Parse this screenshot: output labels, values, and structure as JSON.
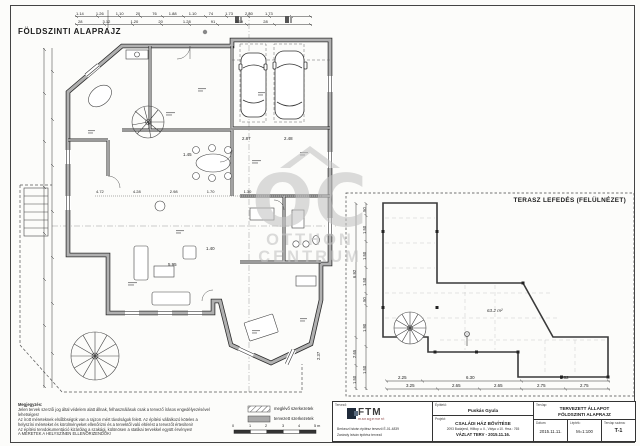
{
  "sheet": {
    "plan_title": "FÖLDSZINTI ALAPRAJZ",
    "terrace_title": "TERASZ LEFEDÉS (FELÜLNÉZET)"
  },
  "watermark": {
    "letters": "OC",
    "line1": "OTTHON",
    "line2": "CENTRUM"
  },
  "plan": {
    "dims_top_row1": [
      "1.14",
      "1.26",
      "1.10",
      "20",
      "76",
      "1.88",
      "1.10",
      "74",
      "1.73",
      "2.80",
      "1.73"
    ],
    "dims_top_row2": [
      "28",
      "3.12",
      "1.20",
      "20",
      "1.28",
      "91",
      "3.19",
      "28"
    ],
    "dims_mid": [
      "4.72",
      "4.28",
      "2.98",
      "1.70",
      "1.30"
    ],
    "room_dims": {
      "living": "5.95",
      "hall": "2.87",
      "dining": "2.48",
      "kitchen": "1.45",
      "corridor": "1.40",
      "bay": "2.37"
    }
  },
  "terrace": {
    "area_label": "63.2 m²",
    "dims_bottom_row1": [
      "2.25",
      "6.30",
      "5.62"
    ],
    "dims_bottom_row2": [
      "3.25",
      "2.65",
      "2.65",
      "2.75",
      "2.75"
    ],
    "dims_left_outer": [
      "6.92",
      "2.65",
      "1.50"
    ],
    "dims_left_inner": [
      ".50",
      "1.50",
      "1.50",
      "1.50",
      ".50",
      "1.90",
      "1.50"
    ]
  },
  "notes": {
    "heading": "Megjegyzés:",
    "lines": [
      "Jelen tervek szerzői jog által védelem alatt állnak, felhasználásuk csak a tervező írásos engedélyezésével",
      "lehetséges!",
      "Az írott méreteknek elsőbbségük van a rajzon mért távolságok felett. Az építési vállalkozó köteles a",
      "helyszíni méreteket és körülményeket ellenőrizni és a tervektől való eltérést a tervezőt értesíteni!",
      "Az építési tervdokumentáció kizárólag a szakági, különösen a statikai tervekkel együtt érvényes!",
      "A MÉRETEK A HELYSZÍNEN ELLENŐRIZENDŐK!"
    ]
  },
  "legend": {
    "existing_label": "meglévő szerkezetek",
    "planned_label": "tervezett szerkezetek",
    "scale_ticks": [
      "0",
      "1",
      "2",
      "3",
      "4",
      "5 m"
    ]
  },
  "title_block": {
    "designer_label": "Tervező:",
    "logo_text": "FTM",
    "logo_sub": "management",
    "designer_line1": "Berkeczi István   építész tervező É-01-4839",
    "designer_line2": "Zarándy István   építész tervező",
    "client_label": "Építtető:",
    "client_name": "Puskás Gyula",
    "project_label": "Projekt:",
    "project_name": "CSALÁDI HÁZ BŐVÍTÉSE",
    "project_address": "2093 Budajenő, Hilltop u. II., Vátya u 10.  Hrsz.: 765",
    "project_phase": "VÁZLAT TERV - 2015.11.16.",
    "sheet_label": "Tervlap:",
    "sheet_title_line1": "TERVEZETT ÁLLAPOT",
    "sheet_title_line2": "FÖLDSZINTI ALAPRAJZ",
    "date_label": "Dátum:",
    "date_value": "2015.11.11.",
    "scale_label": "Lépték:",
    "scale_value": "M=1:100",
    "sheet_no_label": "Tervlap száma:",
    "sheet_no_value": "T-1"
  },
  "colors": {
    "wall_fill": "#b0b0b0",
    "line": "#333333",
    "watermark": "#c3c3c3",
    "grid_dash": "#bbbbbb"
  }
}
